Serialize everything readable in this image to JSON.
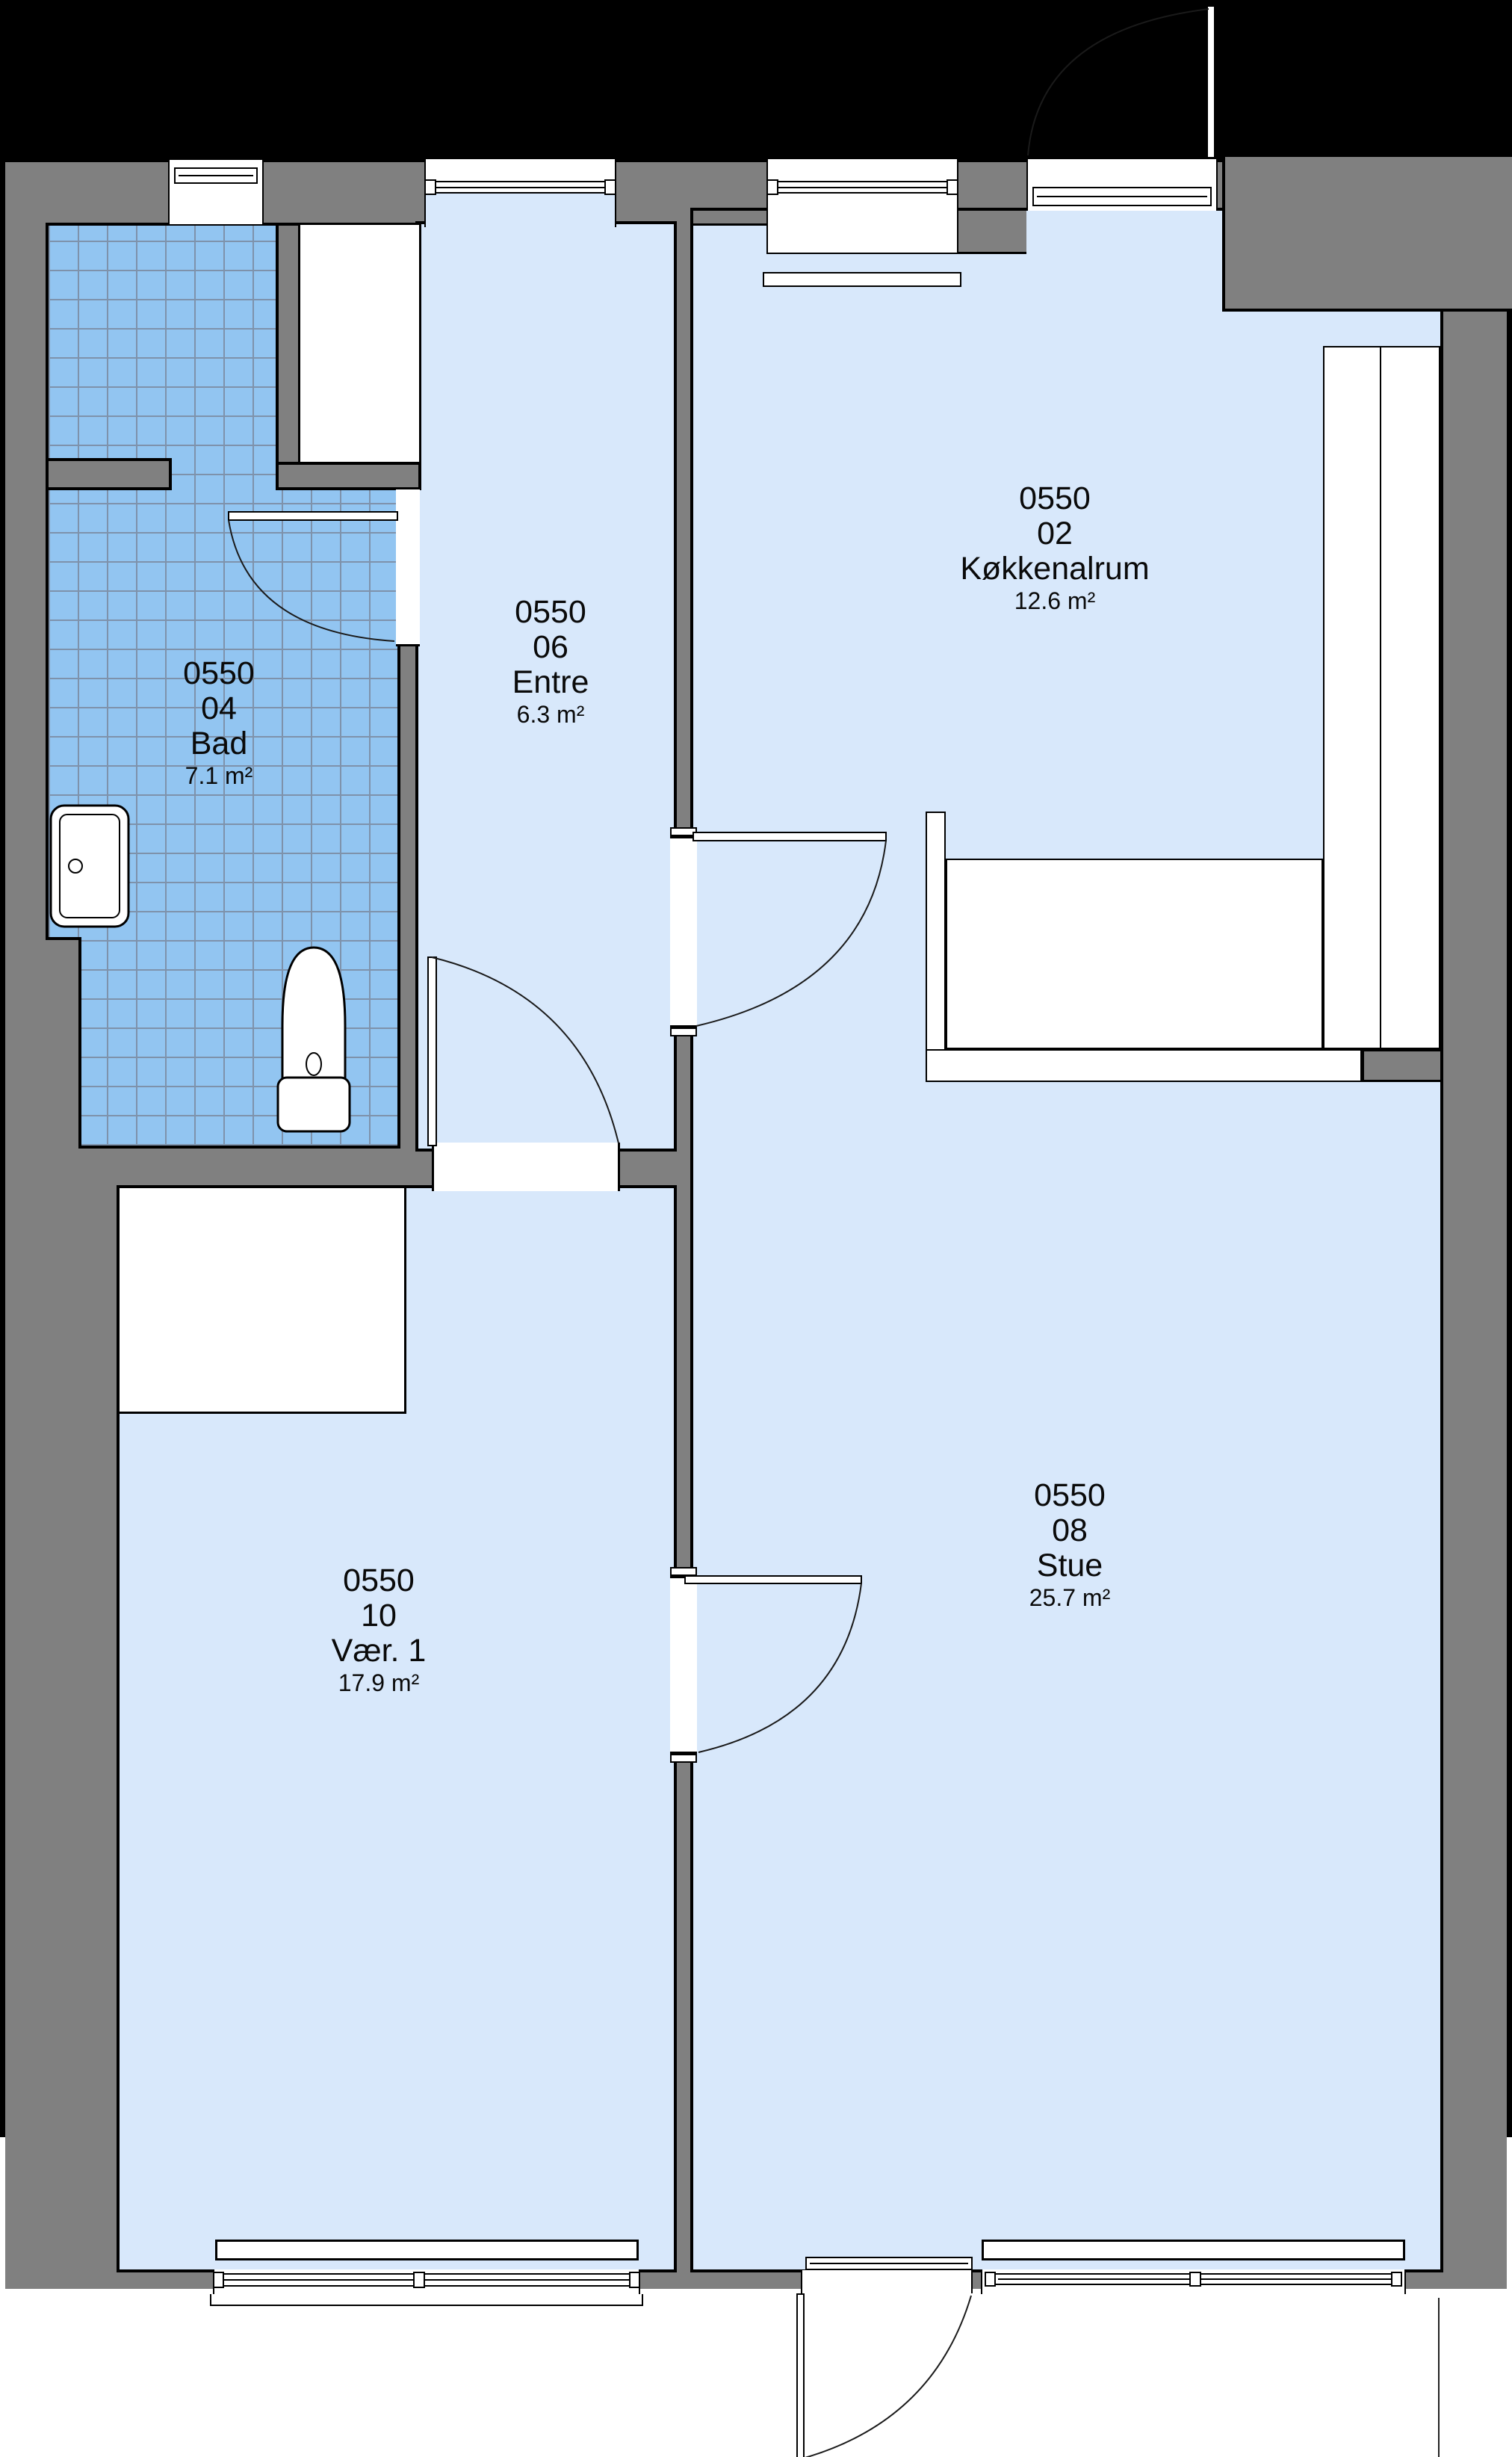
{
  "title": "Lejlighedsplan 0550",
  "rooms": [
    {
      "code": "0550",
      "number": "04",
      "name": "Bad",
      "area": "7.1 m²"
    },
    {
      "code": "0550",
      "number": "06",
      "name": "Entre",
      "area": "6.3 m²"
    },
    {
      "code": "0550",
      "number": "02",
      "name": "Køkkenalrum",
      "area": "12.6 m²"
    },
    {
      "code": "0550",
      "number": "10",
      "name": "Vær. 1",
      "area": "17.9 m²"
    },
    {
      "code": "0550",
      "number": "08",
      "name": "Stue",
      "area": "25.7 m²"
    }
  ],
  "colors": {
    "wall_gray": "#808080",
    "floor_blue": "#d8e8fb",
    "tile_blue": "#92c5f1",
    "tile_grid_line": "#7e92ab",
    "outline_black": "#000000"
  }
}
